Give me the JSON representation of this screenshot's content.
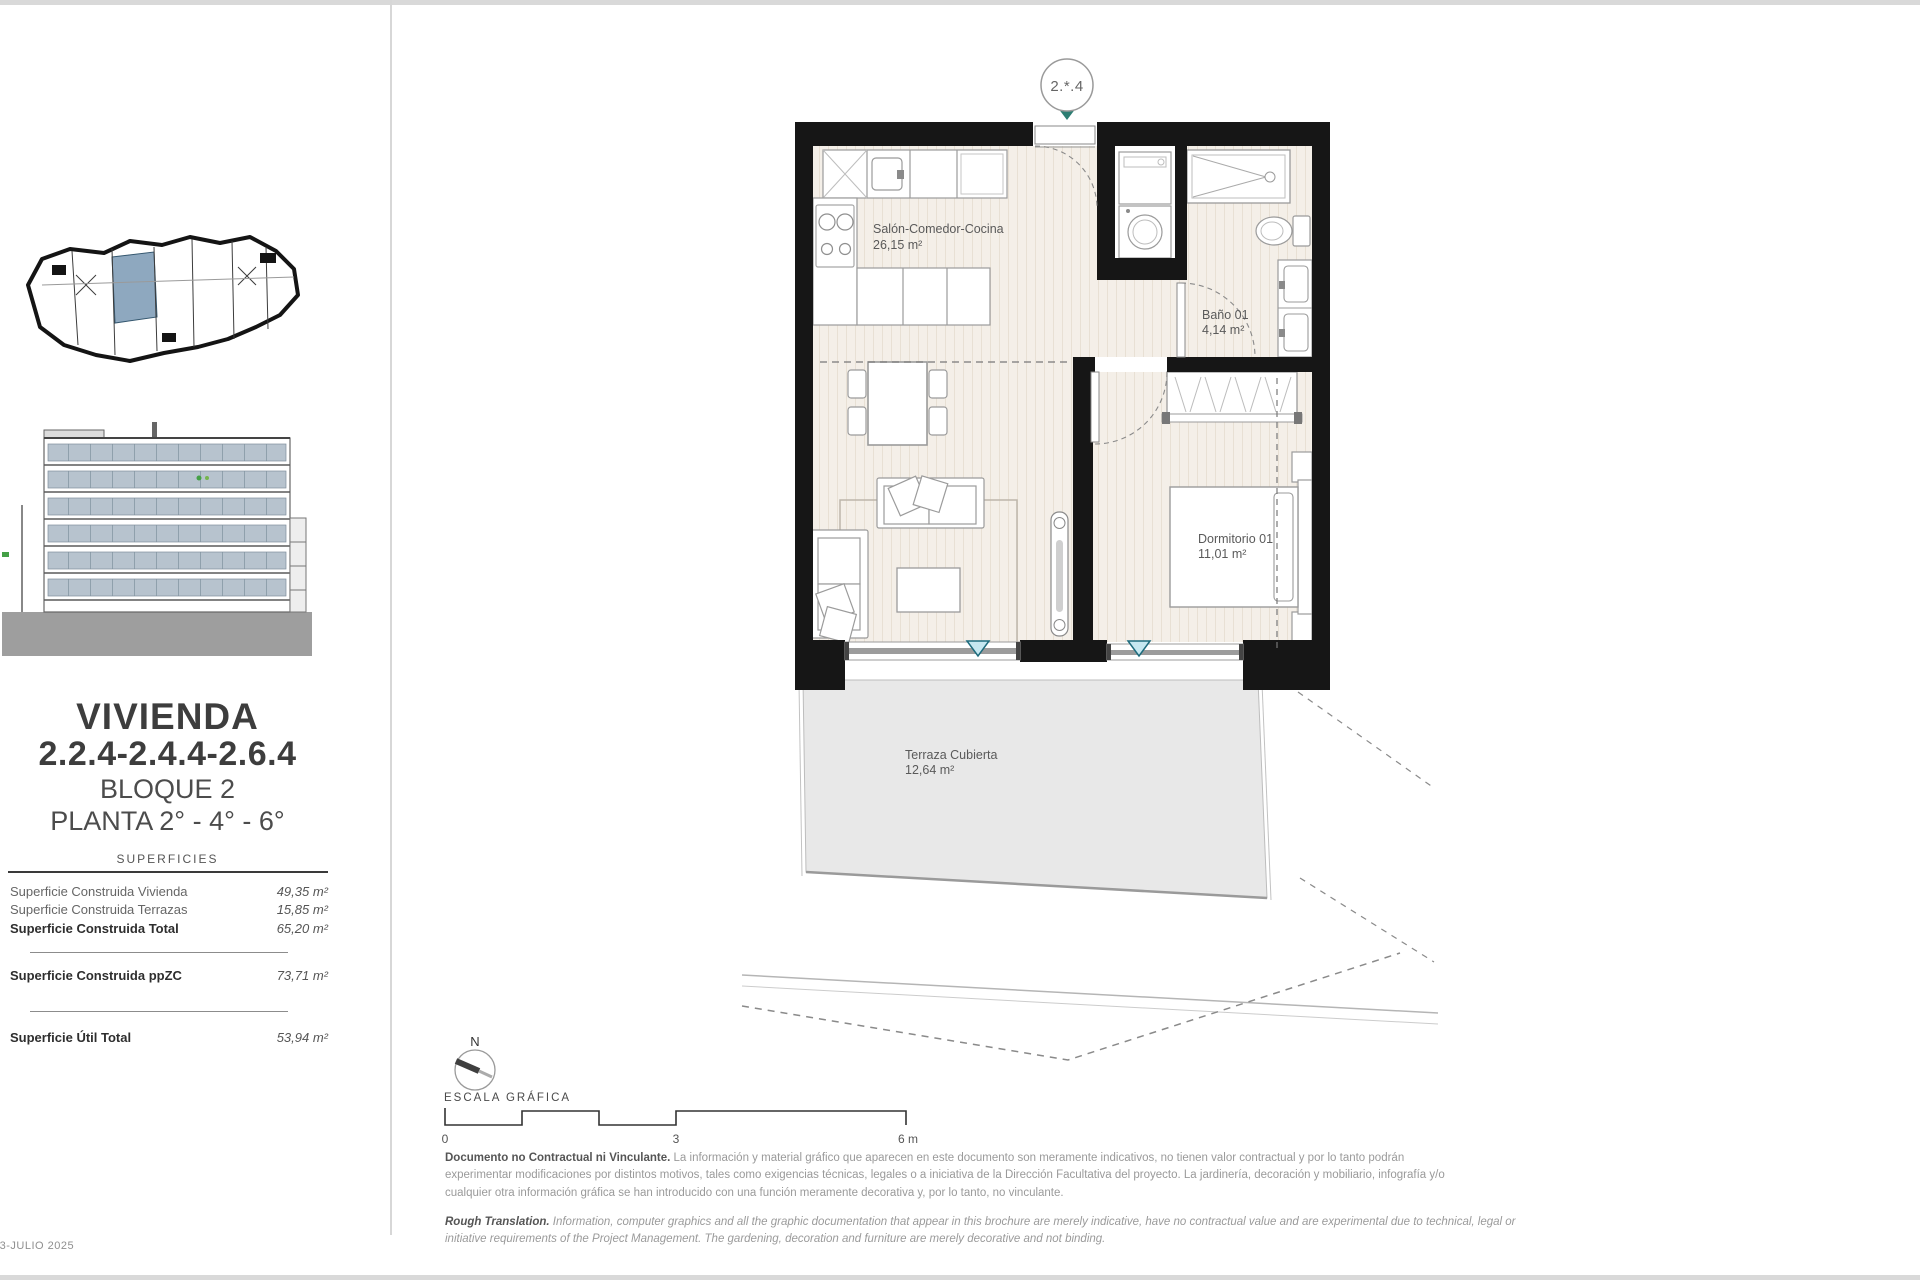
{
  "sidebar": {
    "title": "VIVIENDA",
    "unit_numbers": "2.2.4-2.4.4-2.6.4",
    "block": "BLOQUE 2",
    "floors": "PLANTA 2° - 4° - 6°",
    "surfaces_heading": "SUPERFICIES",
    "surfaces": [
      {
        "label": "Superficie Construida Vivienda",
        "value": "49,35 m²"
      },
      {
        "label": "Superficie Construida Terrazas",
        "value": "15,85 m²"
      },
      {
        "label": "Superficie Construida Total",
        "value": "65,20 m²"
      },
      {
        "label": "Superficie Construida ppZC",
        "value": "73,71 m²"
      },
      {
        "label": "Superficie Útil Total",
        "value": "53,94 m²"
      }
    ],
    "date_stamp": "03-JULIO 2025"
  },
  "plan": {
    "unit_badge": "2.*.4",
    "rooms": {
      "living": {
        "name": "Salón-Comedor-Cocina",
        "area": "26,15 m²"
      },
      "bath": {
        "name": "Baño 01",
        "area": "4,14 m²"
      },
      "bedroom": {
        "name": "Dormitorio 01",
        "area": "11,01 m²"
      },
      "terrace": {
        "name": "Terraza Cubierta",
        "area": "12,64 m²"
      }
    },
    "colors": {
      "wall": "#161616",
      "floor": "#f4efe8",
      "terrace": "#e8e8e8",
      "window_marker": "#c5e7f0",
      "entrance_marker": "#2c7d72",
      "unit_highlight": "#8ea8bf"
    }
  },
  "legend": {
    "north": "N",
    "scale_title": "ESCALA GRÁFICA",
    "tick0": "0",
    "tick3": "3",
    "tick6": "6 m"
  },
  "disclaimer": {
    "es_lead": "Documento no Contractual ni Vinculante.",
    "es_body": " La información y material gráfico que aparecen en este documento son meramente indicativos, no tienen valor contractual y por lo tanto podrán experimentar modificaciones por distintos motivos, tales como exigencias técnicas, legales o a iniciativa de la Dirección Facultativa del proyecto. La jardinería, decoración y mobiliario, infografía y/o cualquier otra información gráfica se han introducido con una función meramente decorativa y, por lo tanto, no vinculante.",
    "en_lead": "Rough Translation.",
    "en_body": " Information, computer graphics and all the graphic documentation that appear in this brochure are merely indicative, have no contractual value and are experimental due to technical, legal or initiative requirements of the Project Management. The gardening, decoration and furniture are merely decorative and not binding."
  }
}
